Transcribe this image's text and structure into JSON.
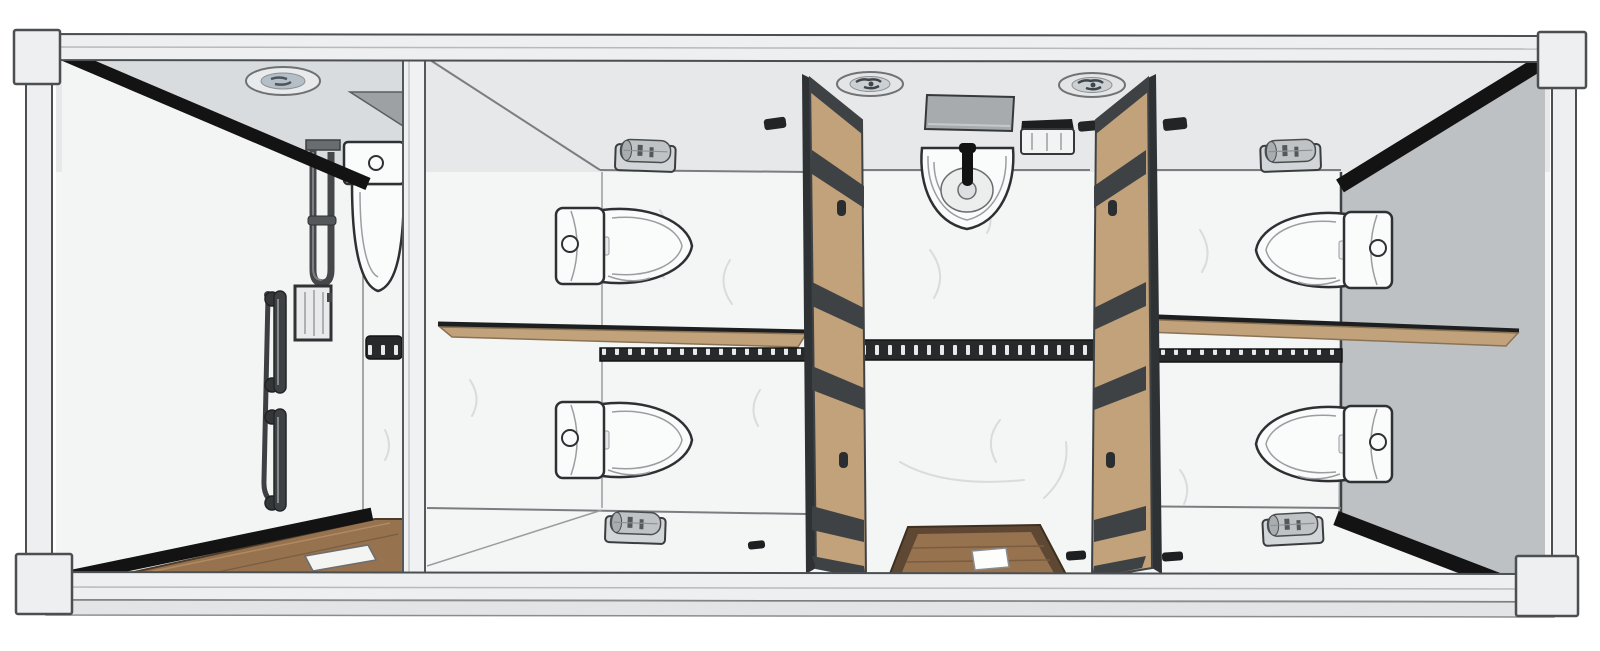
{
  "scene": {
    "type": "3d-cutaway-floor-plan",
    "subject": "modular container restroom unit, top-down dollhouse rendering, no visible text",
    "rooms": [
      {
        "name": "accessible-shower-room",
        "fixtures": [
          "ceiling-light",
          "corner-shelf",
          "toilet",
          "shower-slide-rail",
          "hand-shower-hook",
          "shower-control-box",
          "grab-bar",
          "grab-bar",
          "vent-grille",
          "wood-floor",
          "linear-drain"
        ]
      },
      {
        "name": "stall-top-left",
        "fixtures": [
          "toilet",
          "toilet-paper-holder",
          "wall-switch"
        ]
      },
      {
        "name": "stall-bottom-left",
        "fixtures": [
          "toilet",
          "toilet-paper-holder"
        ]
      },
      {
        "name": "stall-top-right",
        "fixtures": [
          "toilet",
          "toilet-paper-holder",
          "wall-switch"
        ]
      },
      {
        "name": "stall-bottom-right",
        "fixtures": [
          "toilet",
          "toilet-paper-holder"
        ]
      },
      {
        "name": "central-corridor",
        "fixtures": [
          "wash-basin",
          "faucet",
          "mirror",
          "paper-towel-dispenser",
          "ceiling-fan",
          "ceiling-fan",
          "ventilation-strip",
          "entrance-mat",
          "drain-plate"
        ]
      }
    ],
    "counts": {
      "toilets": 5,
      "basins": 1,
      "stall_doors": 4,
      "grab_bars": 2,
      "ceiling_fans": 2,
      "ceiling_lights": 1,
      "partitions": 2
    }
  },
  "palette": {
    "frame": "#edeff0",
    "frameLine": "#4c4f52",
    "wallUpper": "#e6e8e9",
    "ceilingLeft": "#d9dcde",
    "wallLower": "#f4f5f5",
    "roomLeft": "#f3f4f4",
    "rightWall": "#bdc1c4",
    "cutBlack": "#131313",
    "wood": "#c2a27a",
    "woodEdge": "#8a7354",
    "doorFrame": "#3f4245",
    "matWood": "#96724f",
    "matBorder": "#5e4833",
    "metal": "#46494c",
    "metalLight": "#8d9194",
    "fixtureWhite": "#fafbfb",
    "outline": "#2e3133",
    "sketch": "#9b9ea1",
    "grilleDark": "#27292b",
    "grilleSlot": "#e8e9ea",
    "vein": "#d9dbdc",
    "mirror": "#a7abae",
    "shelf": "#9da1a4",
    "fanBlade": "#3f474e"
  }
}
